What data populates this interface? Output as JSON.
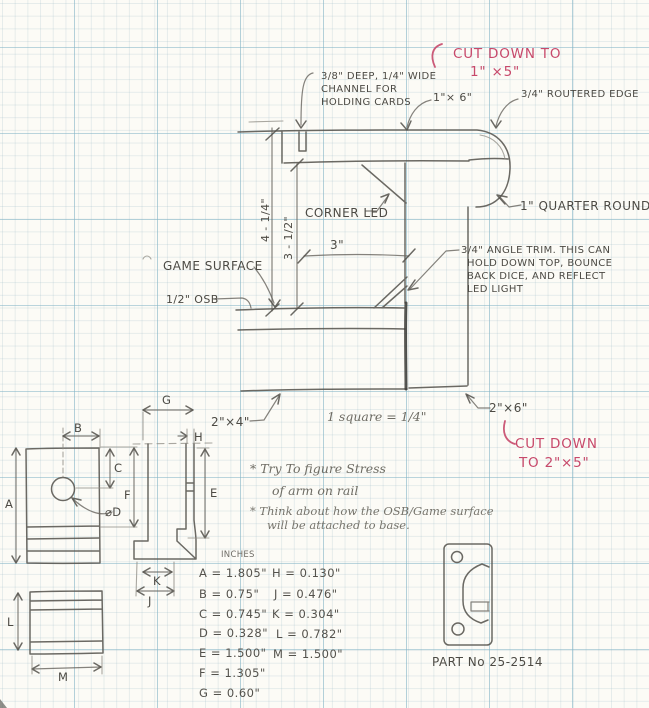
{
  "palette": {
    "paper": "#fcfbf6",
    "grid_major": "#82b4c6",
    "grid_fine": "#c9d8de",
    "pencil": "#56544e",
    "red_ink": "#c7496b"
  },
  "sketch": {
    "top_red_note": {
      "l1": "CUT DOWN TO",
      "l2": "1\" ×5\""
    },
    "channel_note": {
      "l1": "3/8\" DEEP, 1/4\" WIDE",
      "l2": "CHANNEL FOR",
      "l3": "HOLDING CARDS"
    },
    "board_1x6_label": "1\"× 6\"",
    "routered_edge_label": "3/4\" ROUTERED EDGE",
    "quarter_round_label": "1\" QUARTER ROUND",
    "corner_led_label": "CORNER LED",
    "dim_outer_height": "4 - 1/4\"",
    "dim_inner_height": "3 - 1/2\"",
    "dim_width": "3\"",
    "game_surface_label": "GAME SURFACE",
    "osb_label": "1/2\" OSB",
    "angle_trim_note": {
      "l1": "3/4\" ANGLE TRIM. THIS CAN",
      "l2": "HOLD DOWN TOP, BOUNCE",
      "l3": "BACK DICE, AND REFLECT",
      "l4": "LED LIGHT"
    },
    "board_2x4_label": "2\"×4\"",
    "scale_note": "1 square = 1/4\"",
    "board_2x6_label": "2\"×6\"",
    "bottom_red_note": {
      "l1": "CUT DOWN",
      "l2": "TO 2\"×5\""
    },
    "todo_notes": {
      "n1l1": "* Try To figure Stress",
      "n1l2": "of arm on rail",
      "n2l1": "* Think about how the OSB/Game surface",
      "n2l2": "will be attached to base."
    },
    "part_label": "PART No 25-2514"
  },
  "dim_table": {
    "header": "INCHES",
    "col1": [
      "A = 1.805\"",
      "B = 0.75\"",
      "C = 0.745\"",
      "D = 0.328\"",
      "E = 1.500\"",
      "F = 1.305\"",
      "G = 0.60\""
    ],
    "col2": [
      "H = 0.130\"",
      "J = 0.476\"",
      "K = 0.304\"",
      "L = 0.782\"",
      "M = 1.500\""
    ]
  },
  "dim_letters": {
    "a": "A",
    "b": "B",
    "c": "C",
    "d": "⌀D",
    "e": "E",
    "f": "F",
    "g": "G",
    "h": "H",
    "j": "J",
    "k": "K",
    "l": "L",
    "m": "M"
  }
}
